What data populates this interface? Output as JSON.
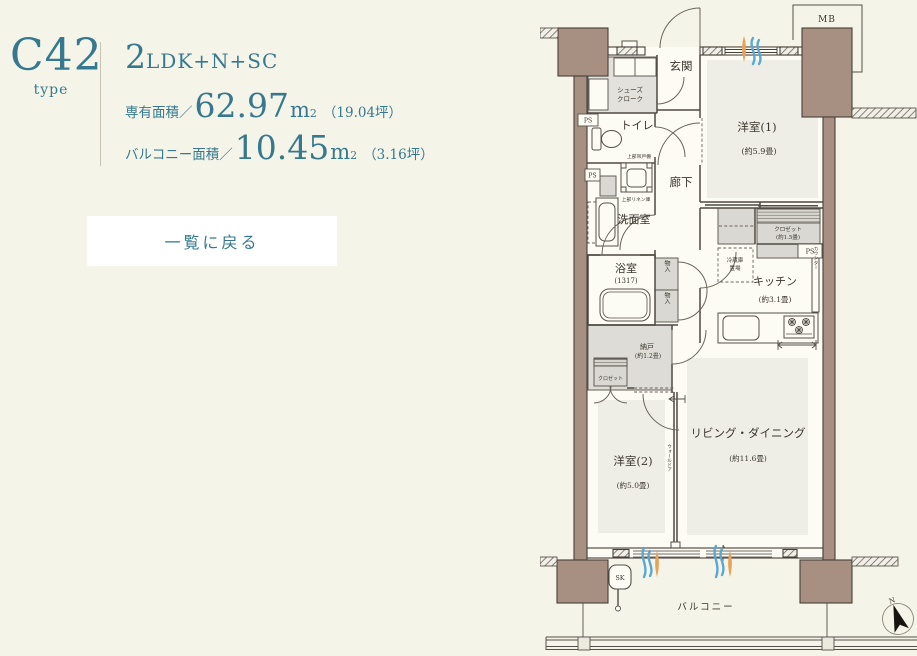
{
  "panel": {
    "type_code": "C42",
    "type_label": "type",
    "layout_num": "2",
    "layout_rest": "LDK+N+SC",
    "area1": {
      "label": "専有面積／",
      "value": "62.97",
      "unit": "m",
      "sup": "2",
      "tsubo": "（19.04坪）"
    },
    "area2": {
      "label": "バルコニー面積／",
      "value": "10.45",
      "unit": "m",
      "sup": "2",
      "tsubo": "（3.16坪）"
    },
    "back_button": "一覧に戻る"
  },
  "plan": {
    "mb": "MB",
    "genkan": "玄関",
    "shoes_line1": "シューズ",
    "shoes_line2": "クローク",
    "toilet": "トイレ",
    "toilet_note": "上部吊戸棚",
    "hallway": "廊下",
    "washroom": "洗面室",
    "washroom_note": "上部リネン庫",
    "bath": "浴室",
    "bath_size": "(1317)",
    "storage1": "物入",
    "storage2": "物入",
    "nando": "納戸",
    "nando_size": "(約1.2畳)",
    "closet_small": "クロゼット",
    "west1": "洋室(1)",
    "west1_size": "(約5.9畳)",
    "closet1_line1": "クロゼット",
    "closet1_line2": "(約1.5畳)",
    "fridge_line1": "冷蔵庫",
    "fridge_line2": "置場",
    "kitchen": "キッチン",
    "kitchen_size": "(約3.1畳)",
    "counter": "カウンター",
    "living": "リビング・ダイニング",
    "living_size": "(約11.6畳)",
    "west2": "洋室(2)",
    "west2_size": "(約5.0畳)",
    "wall_door": "ウォールドア",
    "ps1": "PS",
    "ps2": "PS",
    "ps3": "PS",
    "balcony": "バルコニー",
    "sk": "SK",
    "north": "N"
  },
  "colors": {
    "accent_teal": "#36798f",
    "background": "#f5f4e9",
    "wall_fill": "#a79082",
    "floor_shade": "#efeee6",
    "gray_fill": "#dfded8",
    "highlight_orange": "#e9a257",
    "highlight_blue": "#5aa8d2",
    "button_bg": "#ffffff"
  }
}
